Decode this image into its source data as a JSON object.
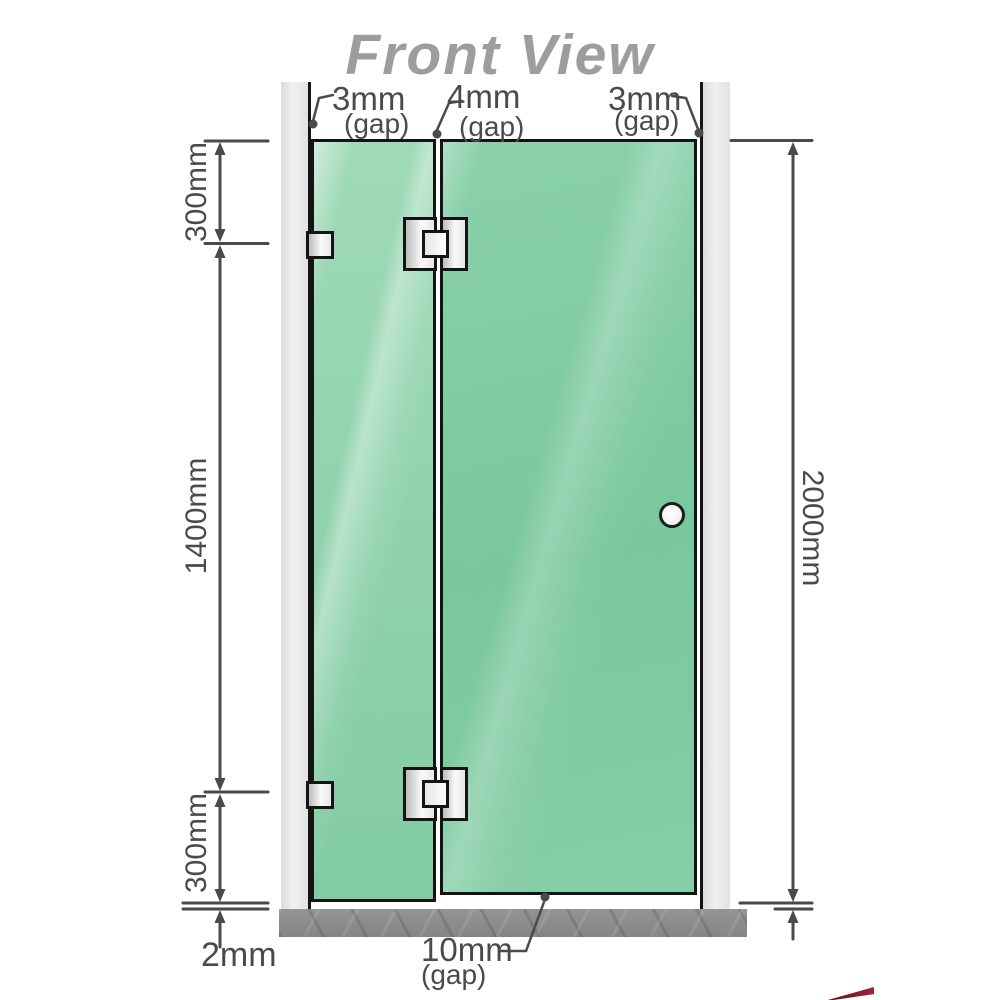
{
  "title": "Front View",
  "diagram": {
    "type": "shower-screen-front-elevation",
    "gaps": {
      "top_left": {
        "value": "3mm",
        "label": "(gap)"
      },
      "top_middle": {
        "value": "4mm",
        "label": "(gap)"
      },
      "top_right": {
        "value": "3mm",
        "label": "(gap)"
      },
      "bottom_door": {
        "value": "10mm",
        "label": "(gap)"
      },
      "bottom_floor": {
        "value": "2mm"
      }
    },
    "dimensions": {
      "left_top": "300mm",
      "left_middle": "1400mm",
      "left_bottom": "300mm",
      "right_total": "2000mm"
    }
  },
  "colors": {
    "glass": "#7fc9a1",
    "glass_highlight": "#b4e2c7",
    "wall_channel": "#e7e7e7",
    "floor": "#8d8d8d",
    "dimension_line": "#4a4a4a",
    "title_text": "#9d9d9d",
    "hardware_metal": "#e8e8e8",
    "outline": "#141414",
    "logo_red": "#8e1b2c"
  }
}
